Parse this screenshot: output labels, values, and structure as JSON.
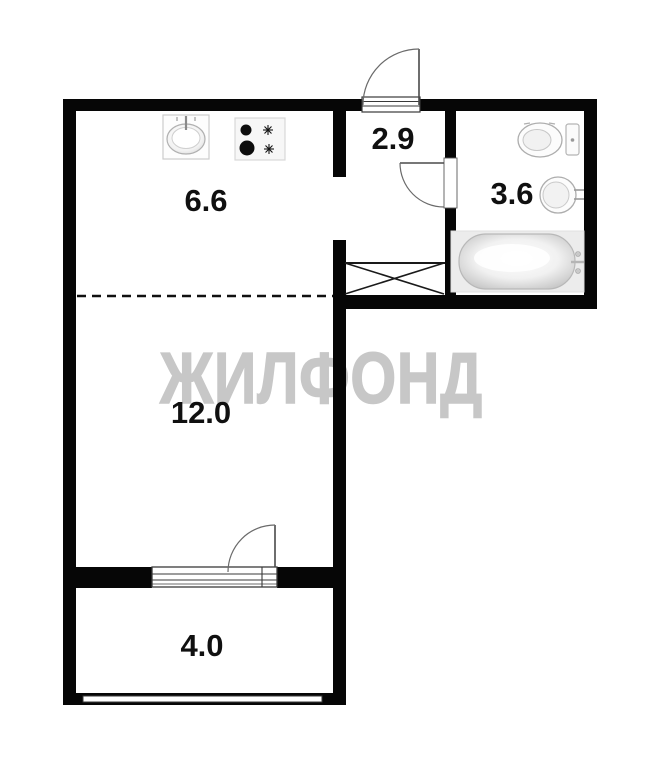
{
  "watermark": "ЖИЛФОНД",
  "rooms": [
    {
      "name": "kitchen",
      "area": "6.6"
    },
    {
      "name": "hallway",
      "area": "2.9"
    },
    {
      "name": "bathroom",
      "area": "3.6"
    },
    {
      "name": "living-room",
      "area": "12.0"
    },
    {
      "name": "balcony",
      "area": "4.0"
    }
  ],
  "fixtures": {
    "kitchen": [
      "kitchen-sink-icon",
      "stove-icon"
    ],
    "bathroom": [
      "toilet-icon",
      "washbasin-icon",
      "bathtub-icon"
    ],
    "hallway": [
      "vent-shaft-icon"
    ]
  },
  "doors": [
    "entrance-door",
    "bathroom-door",
    "balcony-door"
  ],
  "colors": {
    "wall": "#060606",
    "background": "#ffffff",
    "watermark": "#c7c7c7",
    "fixture_stroke": "#b0b0b0",
    "bathtub_panel": "#ececec"
  }
}
